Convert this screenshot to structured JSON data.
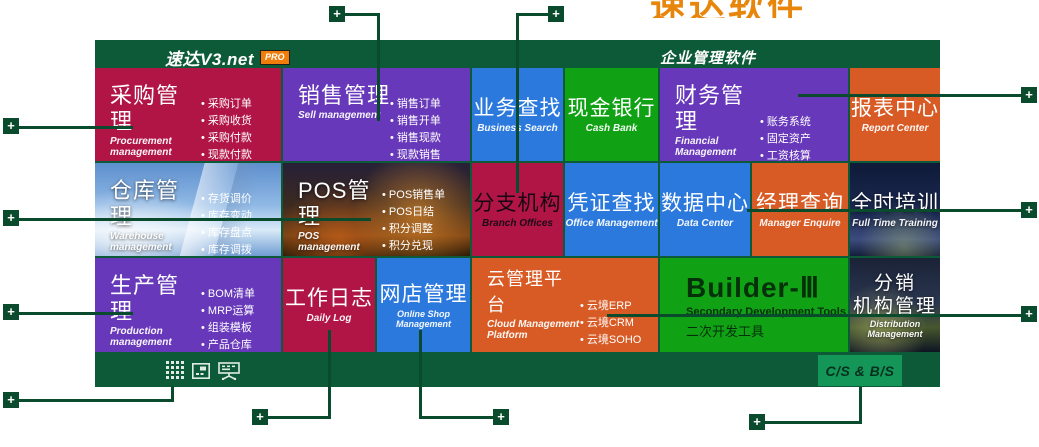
{
  "header": {
    "logo": "速达V3.net",
    "badge": "PRO",
    "product_title": "企业管理软件"
  },
  "banner": {
    "clipped_text": "速达软件"
  },
  "tiles": {
    "procurement": {
      "title": "采购管理",
      "subtitle": "Procurement management",
      "bullets": [
        "采购订单",
        "采购收货",
        "采购付款",
        "现款付款"
      ]
    },
    "sell": {
      "title": "销售管理",
      "subtitle": "Sell management",
      "bullets": [
        "销售订单",
        "销售开单",
        "销售现款",
        "现款销售"
      ]
    },
    "business_search": {
      "title": "业务查找",
      "subtitle": "Business Search"
    },
    "cash_bank": {
      "title": "现金银行",
      "subtitle": "Cash Bank"
    },
    "financial": {
      "title": "财务管理",
      "subtitle": "Financial Management",
      "bullets": [
        "账务系统",
        "固定资产",
        "工资核算"
      ]
    },
    "report_center": {
      "title": "报表中心",
      "subtitle": "Report Center"
    },
    "warehouse": {
      "title": "仓库管理",
      "subtitle": "Warehouse management",
      "bullets": [
        "存货调价",
        "库存变动",
        "库存盘点",
        "库存调拨"
      ]
    },
    "pos": {
      "title": "POS管理",
      "subtitle": "POS management",
      "bullets": [
        "POS销售单",
        "POS日结",
        "积分调整",
        "积分兑现"
      ]
    },
    "branch": {
      "title": "分支机构",
      "subtitle": "Branch Offices"
    },
    "voucher": {
      "title": "凭证查找",
      "subtitle": "Office Management"
    },
    "data_center": {
      "title": "数据中心",
      "subtitle": "Data Center"
    },
    "manager": {
      "title": "经理查询",
      "subtitle": "Manager Enquire"
    },
    "training": {
      "title": "全时培训",
      "subtitle": "Full Time Training"
    },
    "production": {
      "title": "生产管理",
      "subtitle": "Production management",
      "bullets": [
        "BOM清单",
        "MRP运算",
        "组装模板",
        "产品仓库"
      ]
    },
    "daily_log": {
      "title": "工作日志",
      "subtitle": "Daily Log"
    },
    "online_shop": {
      "title": "网店管理",
      "subtitle": "Online Shop Management"
    },
    "cloud": {
      "title": "云管理平台",
      "subtitle": "Cloud Management Platform",
      "bullets": [
        "云境ERP",
        "云境CRM",
        "云境SOHO"
      ]
    },
    "builder": {
      "title": "Builder-Ⅲ",
      "subtitle": "Secondary Development Tools",
      "subtitle_cn": "二次开发工具"
    },
    "distribution": {
      "title_line1": "分销",
      "title_line2": "机构管理",
      "subtitle": "Distribution Management"
    }
  },
  "footer": {
    "cs_bs_label": "C/S & B/S"
  },
  "colors": {
    "panel_green": "#0d5a38",
    "connector_green": "#0a4a2d",
    "crimson": "#b11546",
    "purple": "#6738ba",
    "blue": "#2c79de",
    "green": "#10a214",
    "orange": "#d85b25",
    "csbs_green": "#149659",
    "banner_orange": "#e8860b",
    "badge_orange": "#f07d0a"
  }
}
